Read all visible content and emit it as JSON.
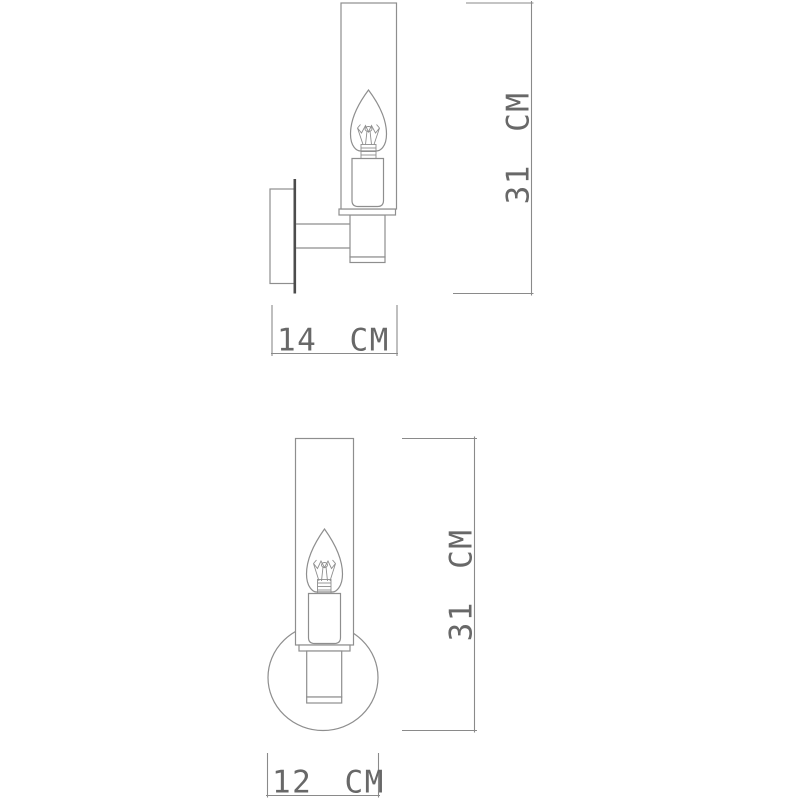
{
  "colors": {
    "bg": "#ffffff",
    "line": "#8e8e8e",
    "line-dark": "#4c4c4c",
    "dim": "#8a8a8a",
    "text": "#686868"
  },
  "views": {
    "side": {
      "height_label": "31 CM",
      "width_label": "14 CM"
    },
    "front": {
      "height_label": "31 CM",
      "width_label": "12 CM"
    }
  }
}
